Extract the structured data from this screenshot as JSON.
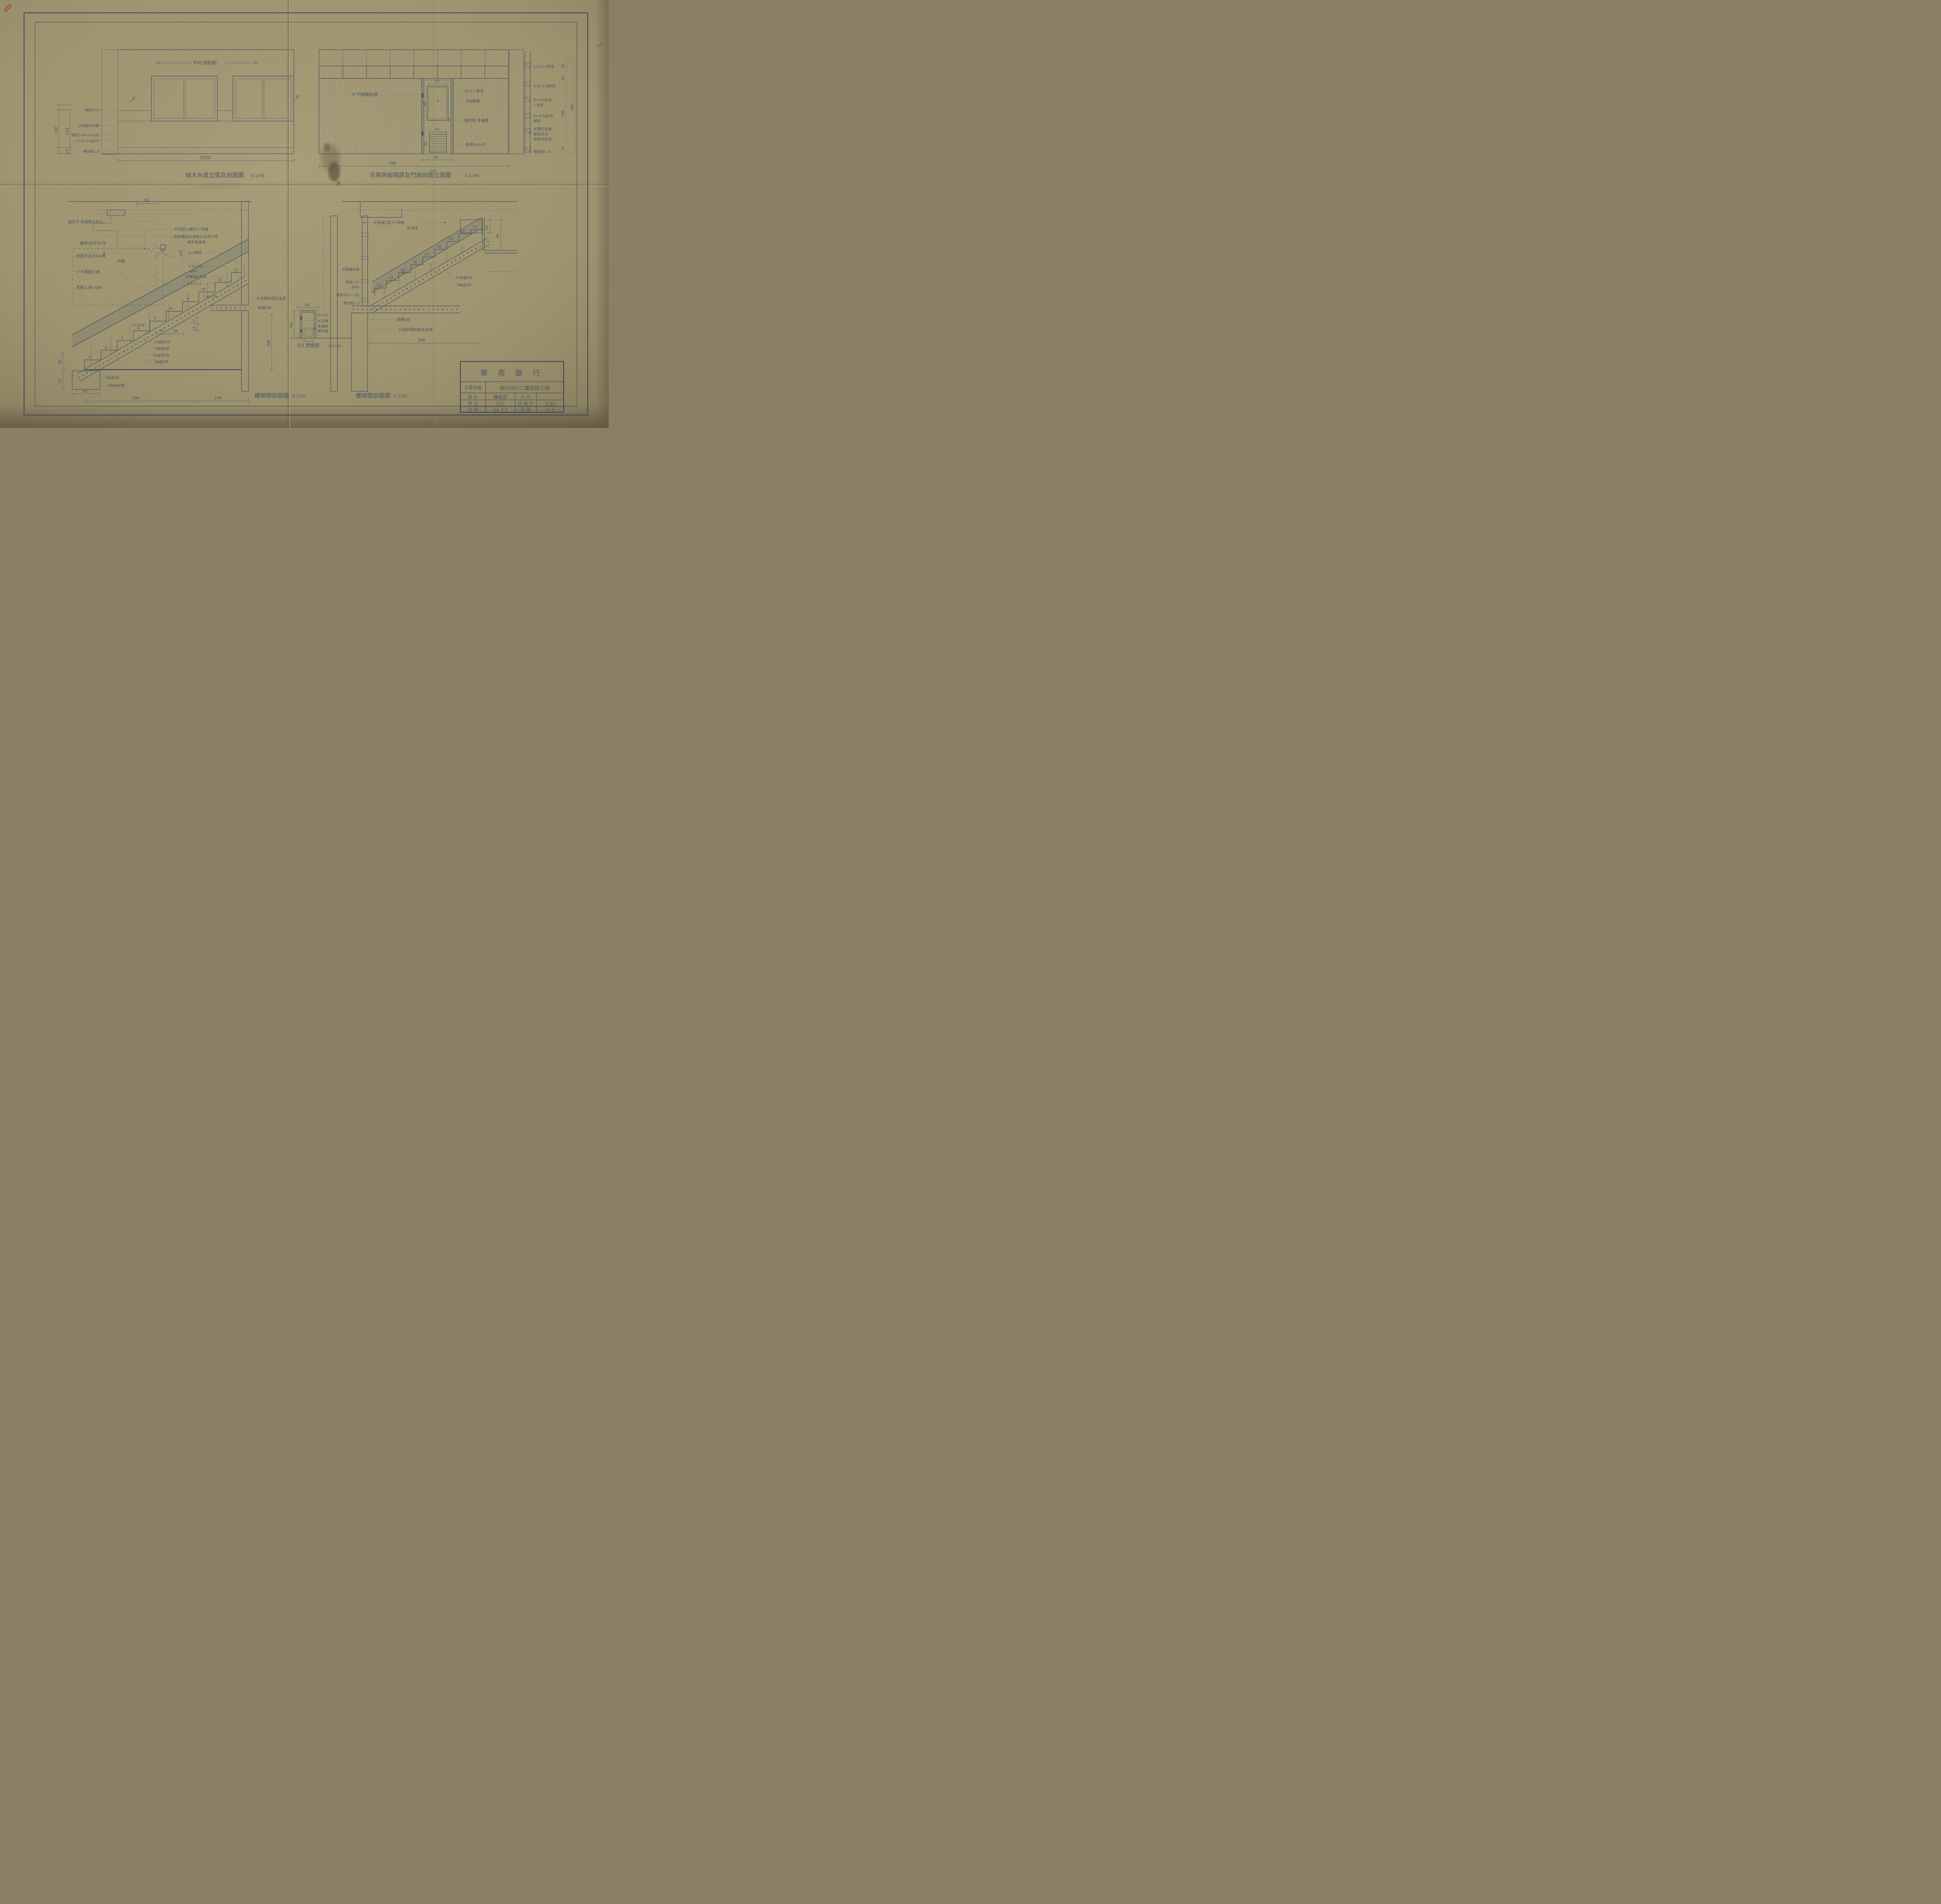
{
  "colors": {
    "paper": "#b3a87f",
    "ink": "#46525f"
  },
  "tb": {
    "bank": "華 南 銀 行",
    "project_label": "工程名稱",
    "project_value": "城內分行二樓改修工程",
    "design_label": "設 計",
    "design_value": "陳森堂",
    "section_label": "科 長",
    "section_value": "",
    "unit_label": "單 位",
    "unit_value": "公分",
    "scale_label": "比 例 尺",
    "scale_value": "1/30",
    "date_label": "日 期",
    "date_value": "64.7.7",
    "no_label": "圖 號",
    "no_value": "A-3"
  },
  "d1": {
    "title": "柚木台度立面及剖面圖",
    "scale": "S:1/30",
    "pvc": "PVC漆粉刷",
    "l1": "柳安6×6",
    "l2": "天興柚木夾板",
    "l3": "柳安3.6×3.6-3支",
    "l4": "〃3.6×3.6@45",
    "l5": "柳安板1.6",
    "dim130": "130",
    "dim115": "115",
    "dim15": "15",
    "dim3500": "3500",
    "mark2l": "2",
    "mark2r": "2"
  },
  "d2": {
    "title": "天興夾板隔屏及門扇剖面立面圖",
    "scale": "S:1/30",
    "hinge": "4\"不銹鋼鉸鏈",
    "dl1": "12×5 柳安",
    "dl2": "3㎜玻璃",
    "dl3": "喇叭鎖 幸福牌",
    "dl4": "板條4.6×5",
    "s1": "12×4.5柳安",
    "s2": "3.6×3.6柳安",
    "s3": "9×4.5柳安",
    "s3b": "一6支",
    "s4": "9×4.5@45",
    "s4b": "柳安",
    "s5a": "天興印花夾",
    "s5b": "板色彩与",
    "s5c": "原有夾板同",
    "s6": "柳安板1.6",
    "dim50g": "50",
    "dim90g": "90",
    "dim50l": "50",
    "dim30l": "30",
    "dim700": "700",
    "dim90d": "90",
    "markD2": "D2",
    "dv1": "45",
    "dv2": "50",
    "dv3": "190",
    "dv4": "15",
    "dv5": "300"
  },
  "d3": {
    "title": "樓梯間剖面圖",
    "scale": "S:1/30",
    "n1": "天花缺口補釘¼\"夾板",
    "n2": "拆除楼板及墙面以水泥沙浆",
    "n3": "補平並油漆",
    "n4": "磨石子.兩端黑色滾边.",
    "n5": "柚木扶手9×5",
    "n6": "奇美压克力5㎜厚",
    "n6b": "双面",
    "n7": "1\"不銹鋼方管",
    "n8": "青銅上滑=100",
    "w1": "6×6柳安",
    "w2": "3.6×3.6",
    "w2b": "@45",
    "w3": "天興柚木夾板",
    "w4": "3.6×3.6",
    "w5": "1.6×15",
    "wall1": "水泥漿粉刷及油漆",
    "wall2": "砌磚½B",
    "r1": "12φ@10",
    "r2": "9φ@20",
    "r3": "12φ@10",
    "r4": "9φ@20",
    "r5": "9φ@30",
    "r6": "16φ@4支",
    "tnote": "t=12㎝",
    "d26a": "26",
    "d26b": "26",
    "d17": "17",
    "d12": "12",
    "d90": "90",
    "d200": "200",
    "d208": "208",
    "d60": "60",
    "d10": "10",
    "d40": "40",
    "d286": "286",
    "d140": "140",
    "steps": [
      "3",
      "4",
      "5",
      "6",
      "7",
      "8",
      "9",
      "10",
      "11",
      "12"
    ]
  },
  "d4": {
    "title": "樓梯間剖面圖",
    "scale": "S:1/30",
    "n1": "天花缺口釘¼\"夾板",
    "n1b": "及油漆",
    "w1": "天興柚木板",
    "w2": "柳安3.6²",
    "w2b": "@45",
    "w3": "柳安3.6²一3支",
    "w4": "柳安板1.6",
    "wall1": "砌磚1B.",
    "wall2": "水泥砂漿粉刷及油漆",
    "r1": "12φ@10",
    "r2": "9φ@20",
    "d30": "30",
    "d90": "90",
    "d90w": "90",
    "d208": "208",
    "steps": [
      "13",
      "14",
      "15",
      "16",
      "17",
      "18",
      "19",
      "20",
      "21"
    ]
  },
  "dd3": {
    "title": "D3 立面圖",
    "scale": "S:1/30",
    "l1": "9×4.5",
    "l2": "4CM厚",
    "l3": "幸福牌",
    "l4": "喇叭鎖",
    "dw": "60",
    "dh": "160",
    "dl": "30"
  }
}
